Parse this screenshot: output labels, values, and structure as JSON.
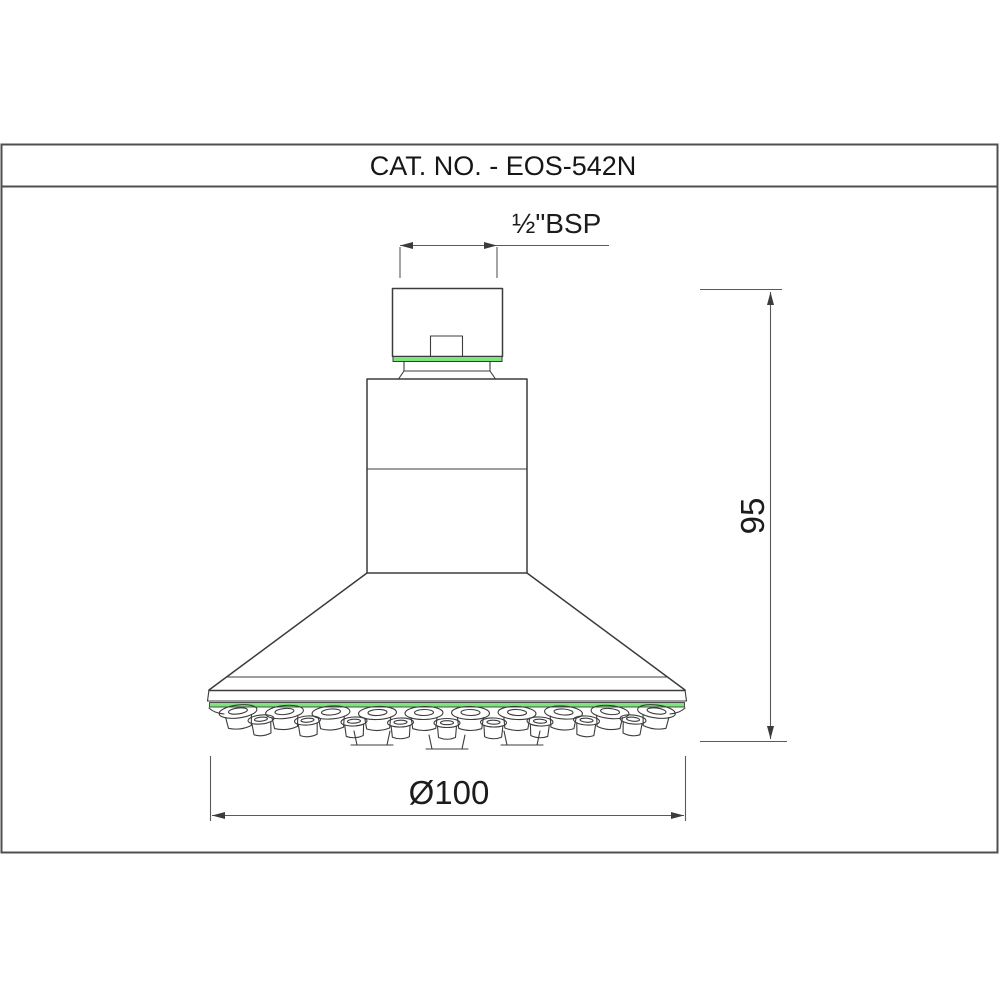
{
  "sheet": {
    "title": "CAT. NO. - EOS-542N"
  },
  "dimensions": {
    "thread_label": "½\"BSP",
    "height_label": "95",
    "diameter_label": "Ø100"
  },
  "colors": {
    "accent_green": "#7de57d",
    "outline": "#3c3c3c",
    "dimension_line": "#5a5a5a",
    "frame_border": "#4f4f4f"
  }
}
